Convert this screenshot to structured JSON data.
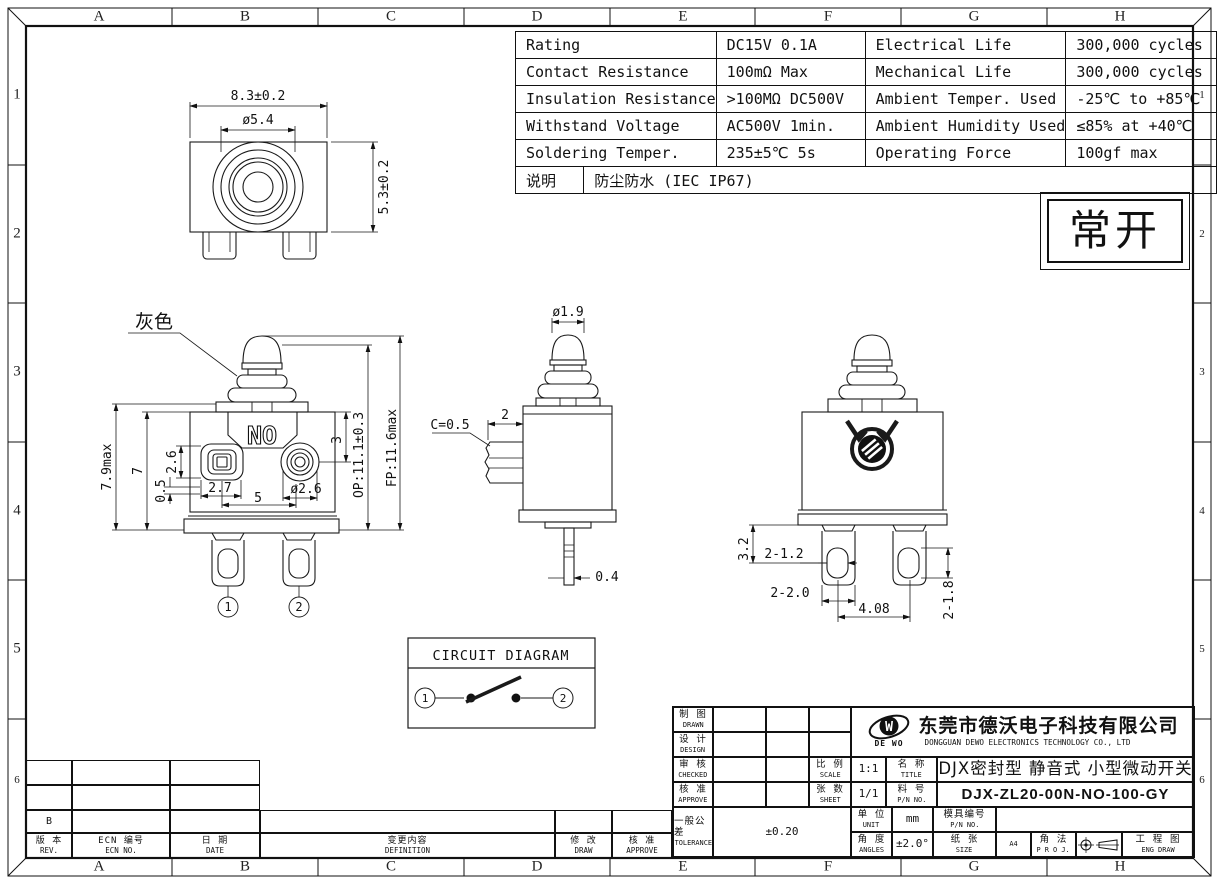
{
  "border": {
    "top_letters": [
      "A",
      "B",
      "C",
      "D",
      "E",
      "F",
      "G",
      "H"
    ],
    "bottom_letters": [
      "A",
      "B",
      "C",
      "D",
      "E",
      "F",
      "G",
      "H"
    ],
    "left_numbers": [
      "1",
      "2",
      "3",
      "4",
      "5",
      "6"
    ],
    "right_numbers": [
      "1",
      "2",
      "3",
      "4",
      "5",
      "6"
    ]
  },
  "spec_table": {
    "rows": [
      [
        "Rating",
        "DC15V 0.1A",
        "Electrical Life",
        "300,000 cycles"
      ],
      [
        "Contact Resistance",
        "100mΩ Max",
        "Mechanical Life",
        "300,000 cycles"
      ],
      [
        "Insulation Resistance",
        ">100MΩ DC500V",
        "Ambient Temper. Used",
        "-25℃ to +85℃"
      ],
      [
        "Withstand Voltage",
        "AC500V 1min.",
        "Ambient Humidity Used",
        "≤85% at +40℃"
      ],
      [
        "Soldering Temper.",
        "235±5℃ 5s",
        "Operating Force",
        "100gf max"
      ]
    ],
    "note_label": "说明",
    "note_value": "防尘防水 (IEC IP67)"
  },
  "state_box": {
    "text": "常开"
  },
  "views": {
    "top": {
      "width": "8.3±0.2",
      "dia": "ø5.4",
      "height": "5.3±0.2"
    },
    "front": {
      "color_label": "灰色",
      "plate": "NO",
      "h_max": "7.9max",
      "h_body": "7",
      "boss_h": "2.6",
      "gap": "0.5",
      "boss_w": "2.7",
      "pitch": "5",
      "dia": "ø2.6",
      "depth": "3",
      "op": "OP:11.1±0.3",
      "fp": "FP:11.6max",
      "t1": "1",
      "t2": "2"
    },
    "side": {
      "dia": "ø1.9",
      "chamfer": "C=0.5",
      "tab_w": "2",
      "term_t": "0.4"
    },
    "rear": {
      "edge_hole": "3.2",
      "holes": "2-1.2",
      "legs": "2-2.0",
      "pitch": "4.08",
      "slots": "2-1.8"
    }
  },
  "circuit": {
    "title": "CIRCUIT DIAGRAM",
    "t1": "1",
    "t2": "2"
  },
  "title_block": {
    "drawn": {
      "zh": "制 图",
      "en": "DRAWN"
    },
    "design": {
      "zh": "设 计",
      "en": "DESIGN"
    },
    "checked": {
      "zh": "审 核",
      "en": "CHECKED"
    },
    "approve": {
      "zh": "核 准",
      "en": "APPROVE"
    },
    "tolerance": {
      "zh": "一般公差",
      "en": "TOLERANCE",
      "value": "±0.20"
    },
    "scale": {
      "zh": "比 例",
      "en": "SCALE",
      "value": "1:1"
    },
    "sheet": {
      "zh": "张 数",
      "en": "SHEET",
      "value": "1/1"
    },
    "unit": {
      "zh": "单 位",
      "en": "UNIT",
      "value": "mm"
    },
    "angles": {
      "zh": "角 度",
      "en": "ANGLES",
      "value": "±2.0°"
    },
    "name": {
      "zh": "名 称",
      "en": "TITLE",
      "value": "DJX密封型 静音式 小型微动开关"
    },
    "pn": {
      "zh": "料 号",
      "en": "P/N NO.",
      "value": "DJX-ZL20-00N-NO-100-GY"
    },
    "mold": {
      "zh": "模具编号",
      "en": "P/N NO.",
      "value": ""
    },
    "paper": {
      "zh": "纸 张",
      "en": "SIZE",
      "value": "A4"
    },
    "proj": {
      "zh": "角 法",
      "en": "P R O J."
    },
    "eng": {
      "zh": "工 程 图",
      "en": "ENG DRAW"
    },
    "company": {
      "zh": "东莞市德沃电子科技有限公司",
      "en": "DONGGUAN DEWO ELECTRONICS TECHNOLOGY CO., LTD",
      "logo": "DE WO",
      "logo_letter": "W"
    }
  },
  "revision": {
    "rev_value": "B",
    "cols": [
      {
        "zh": "版 本",
        "en": "REV."
      },
      {
        "zh": "ECN 编号",
        "en": "ECN NO."
      },
      {
        "zh": "日 期",
        "en": "DATE"
      },
      {
        "zh": "变更内容",
        "en": "DEFINITION"
      },
      {
        "zh": "修 改",
        "en": "DRAW"
      },
      {
        "zh": "核 准",
        "en": "APPROVE"
      }
    ]
  }
}
